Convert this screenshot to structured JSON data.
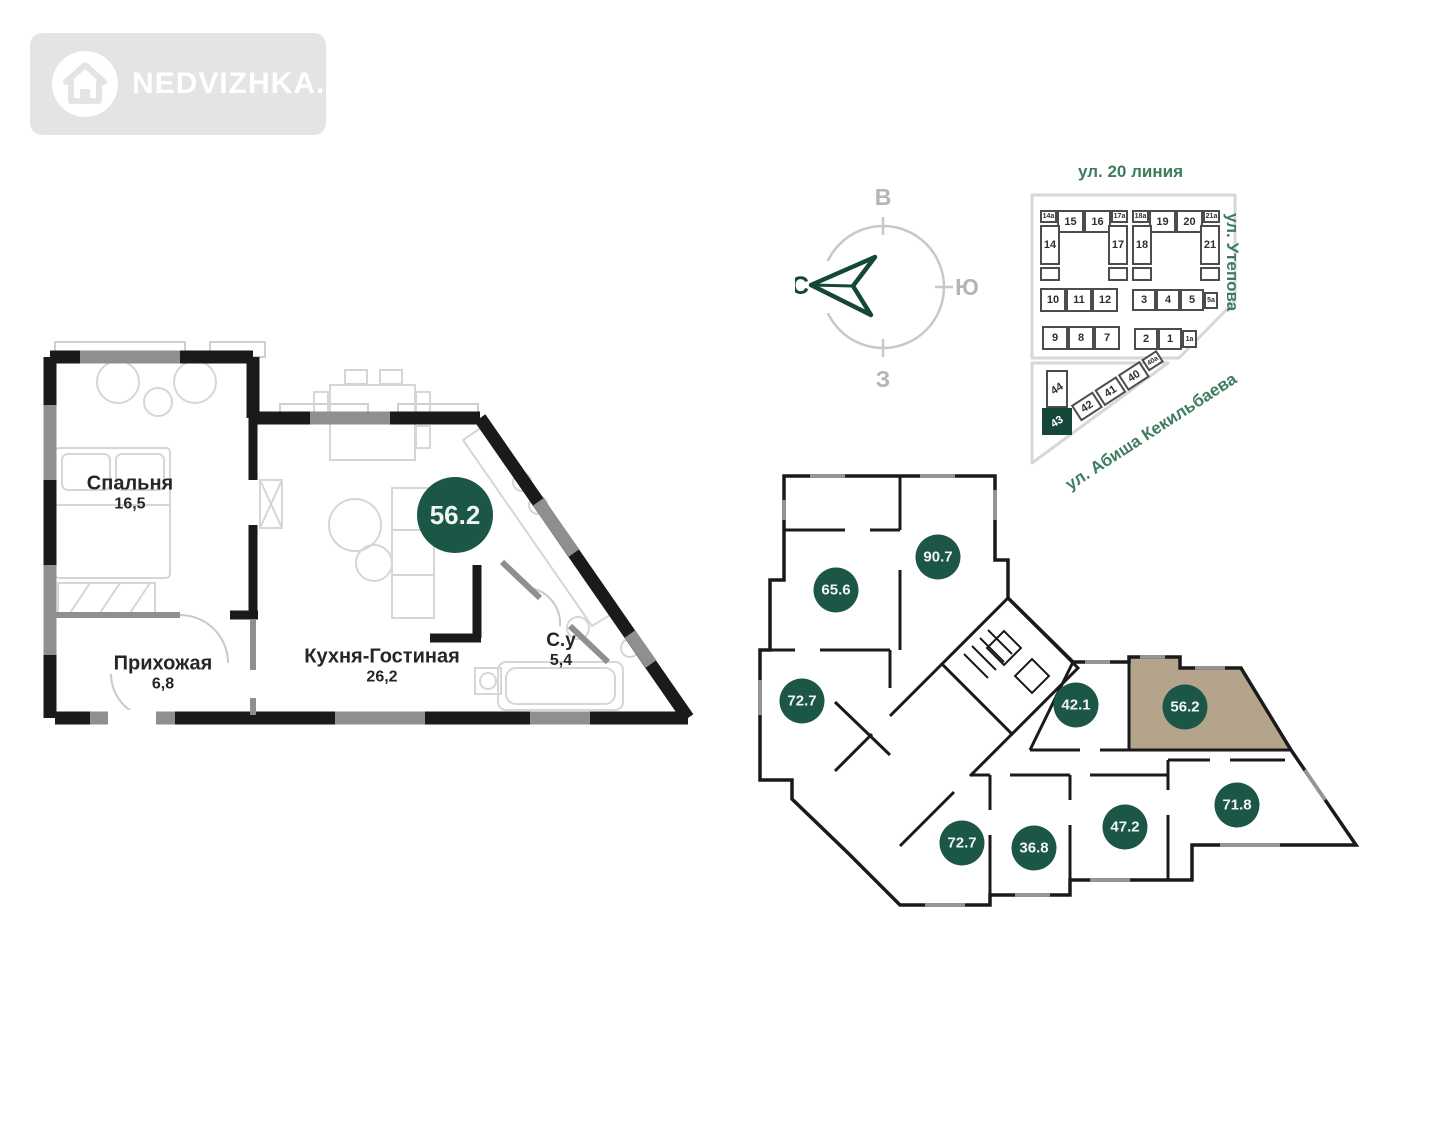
{
  "logo": {
    "text": "NEDVIZHKA.KZ"
  },
  "apartment_plan": {
    "total_area": "56.2",
    "rooms": [
      {
        "name": "Спальня",
        "area": "16,5"
      },
      {
        "name": "Прихожая",
        "area": "6,8"
      },
      {
        "name": "Кухня-Гостиная",
        "area": "26,2"
      },
      {
        "name": "С.у",
        "area": "5,4"
      }
    ]
  },
  "compass": {
    "north": "С",
    "east": "В",
    "south": "Ю",
    "west": "З"
  },
  "site_plan": {
    "streets": {
      "top": "ул. 20 линия",
      "right": "ул. Утепова",
      "diagonal": "ул. Абиша Кекильбаева"
    },
    "selected_block": "43",
    "blocks": [
      "14а",
      "15",
      "16",
      "17а",
      "14",
      "17",
      "18а",
      "19",
      "20",
      "21а",
      "18",
      "21",
      "10",
      "11",
      "12",
      "3",
      "4",
      "5",
      "5а",
      "9",
      "8",
      "7",
      "2",
      "1",
      "1а",
      "44",
      "43",
      "42",
      "41",
      "40",
      "40а"
    ]
  },
  "floor_plate": {
    "selected_unit": "56.2",
    "units": [
      "90.7",
      "65.6",
      "72.7",
      "42.1",
      "56.2",
      "72.7",
      "36.8",
      "47.2",
      "71.8"
    ]
  },
  "colors": {
    "accent_green": "#1b5647",
    "north_green": "#14463a",
    "street_green": "#3e7c5e",
    "highlight_tan": "#b5a48c",
    "wall_black": "#1a1a1a",
    "window_gray": "#8f8f8f",
    "logo_gray": "#e4e4e4"
  }
}
